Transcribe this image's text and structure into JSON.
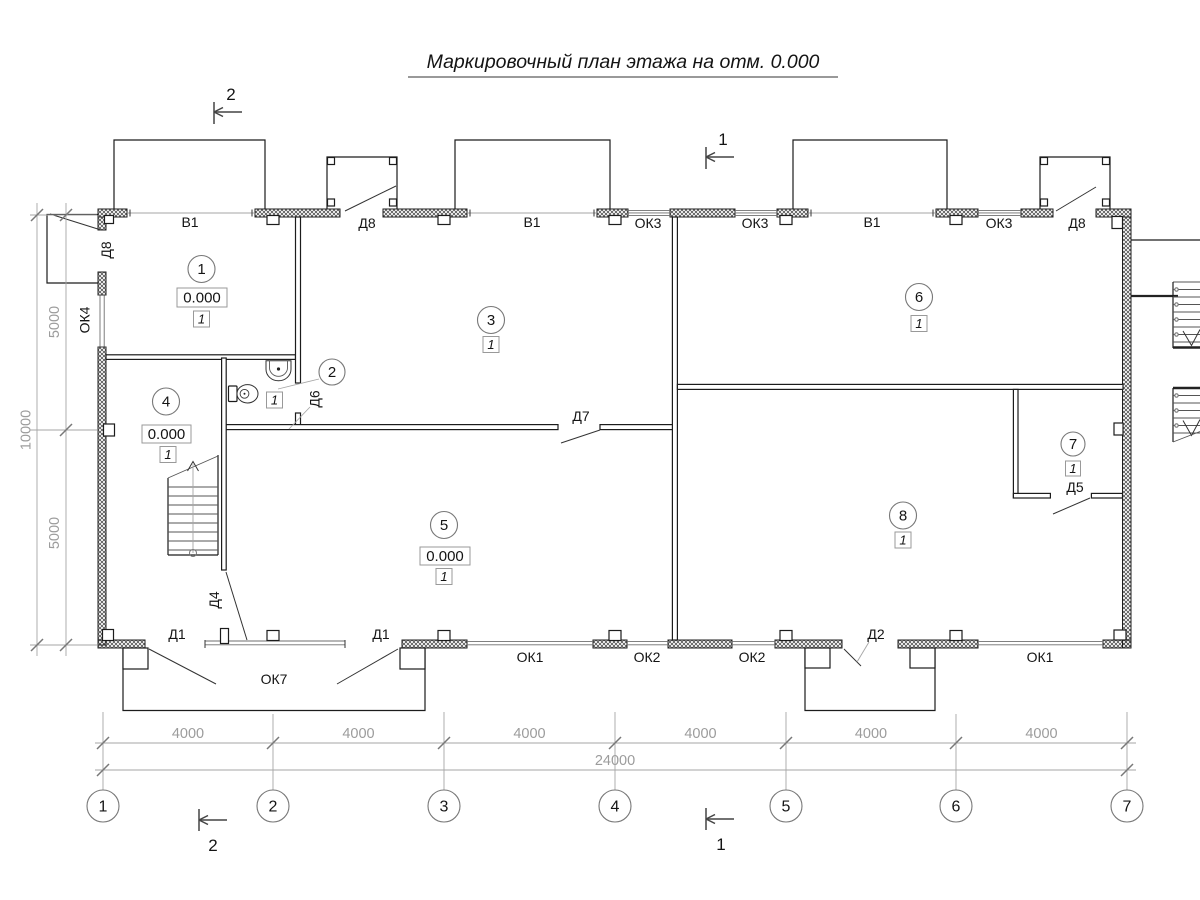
{
  "title": "Маркировочный план этажа на отм. 0.000",
  "section_marks": {
    "top_left": "2",
    "top_middle": "1",
    "bottom_left": "2",
    "bottom_middle": "1"
  },
  "axis_bubbles": [
    "1",
    "2",
    "3",
    "4",
    "5",
    "6",
    "7"
  ],
  "dimensions": {
    "bottom_bays": [
      "4000",
      "4000",
      "4000",
      "4000",
      "4000",
      "4000"
    ],
    "bottom_total": "24000",
    "left_upper": "5000",
    "left_lower": "5000",
    "left_total": "10000"
  },
  "rooms": [
    {
      "number": "1",
      "elevation": "0.000",
      "type": "1"
    },
    {
      "number": "2",
      "type": "1"
    },
    {
      "number": "3",
      "type": "1"
    },
    {
      "number": "4",
      "elevation": "0.000",
      "type": "1"
    },
    {
      "number": "5",
      "elevation": "0.000",
      "type": "1"
    },
    {
      "number": "6",
      "type": "1"
    },
    {
      "number": "7",
      "type": "1"
    },
    {
      "number": "8",
      "type": "1"
    }
  ],
  "opening_labels": {
    "top": [
      "В1",
      "Д8",
      "В1",
      "ОК3",
      "ОК3",
      "В1",
      "ОК3",
      "Д8"
    ],
    "bottom": [
      "Д1",
      "ОК7",
      "Д1",
      "ОК1",
      "ОК2",
      "ОК2",
      "Д2",
      "ОК1"
    ],
    "left_wall_door": "Д8",
    "left_wall_window": "ОК4",
    "door_d6": "Д6",
    "door_d4": "Д4",
    "door_d7": "Д7",
    "door_d5": "Д5"
  },
  "colors": {
    "line": "#1c1c1c",
    "dim": "#9c9c9c",
    "background": "#ffffff"
  }
}
